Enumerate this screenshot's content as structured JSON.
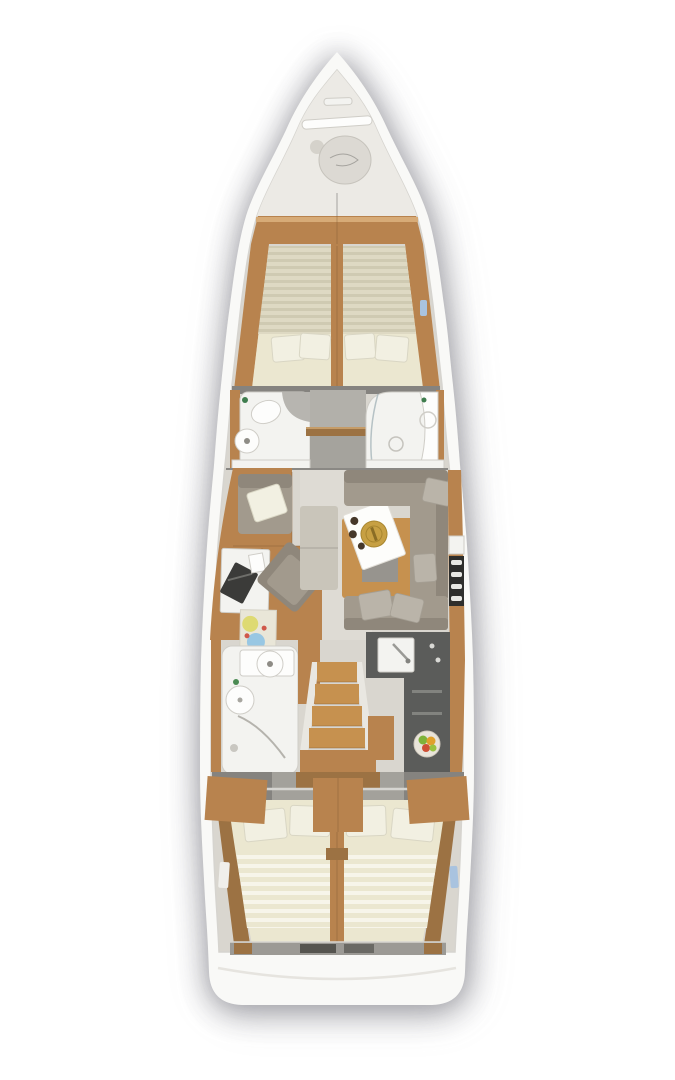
{
  "colors": {
    "page_bg": "#ffffff",
    "hull": "#f9f9f7",
    "hull_edge": "#d6d4cf",
    "deck_bow": "#eceae5",
    "floor": "#d9d6cf",
    "floor_light": "#e0ddd6",
    "wall_dark": "#85837f",
    "wall_gray": "#b2b0aa",
    "corridor_lower": "#a5a39d",
    "wood": "#b8834e",
    "wood_light": "#c6914f",
    "wood_dark": "#9c7243",
    "wood_line": "#7c5730",
    "counter_dark": "#5b5c5a",
    "fixture": "#f3f3f0",
    "fixture_line": "#cfcdc7",
    "sofa": "#a29a8d",
    "sofa_dark": "#8f877b",
    "sofa_pillow": "#bab4a9",
    "mattress_fwd": "#ded9c3",
    "mattress_fwd_stripe": "#cfcab2",
    "mattress_aft": "#ebe7d0",
    "mattress_aft_stripe": "#f7f5ea",
    "pillow": "#f2f0e2",
    "pillow_edge": "#d9d6c4",
    "hatch_blue": "#a9c3df",
    "brass": "#c7a043",
    "steel": "#9a9a96",
    "chart_yellow": "#ddd867",
    "chart_blue": "#8fc3e4",
    "chart_red": "#d0584a",
    "fruit_green": "#7fb33a",
    "fruit_orange": "#e0a12c",
    "fruit_red": "#cf4f35"
  },
  "floor_plan": {
    "vessel": "sailing-yacht interior floor plan, top view, bow up",
    "sections_bow_to_stern": [
      "anchor-locker",
      "forward-cabin-v-berth",
      "port-forward-head",
      "starboard-forward-shower",
      "salon",
      "port-aft-head",
      "companionway-stairs",
      "starboard-galley",
      "port-aft-cabin",
      "starboard-aft-cabin",
      "transom"
    ],
    "features": [
      {
        "area": "anchor-locker",
        "items": [
          "windlass-bar",
          "anchor-rope-coil"
        ]
      },
      {
        "area": "forward-cabin",
        "items": [
          "split-v-berth",
          "four-pillows",
          "wood-side-shelves",
          "blue-deck-hatch"
        ]
      },
      {
        "area": "port-forward-head",
        "items": [
          "toilet",
          "round-washbasin"
        ]
      },
      {
        "area": "starboard-forward-shower",
        "items": [
          "shower-pan-with-drain",
          "washbasin"
        ]
      },
      {
        "area": "salon",
        "items": [
          "armchair-with-pillow",
          "nav-desk-with-laptop",
          "swivel-chair",
          "chart-rug",
          "dining-table",
          "serving-tray-with-brass-plate",
          "bench",
          "l-shaped-sofa-with-pillows",
          "sideboard-bottle-rack"
        ]
      },
      {
        "area": "galley",
        "items": [
          "l-shaped-dark-counter",
          "square-sink-with-faucet",
          "fruit-bowl"
        ]
      },
      {
        "area": "companionway",
        "items": [
          "four-wood-steps",
          "landing-platform"
        ]
      },
      {
        "area": "port-aft-head",
        "items": [
          "washbasin-counter",
          "toilet",
          "shower-with-curved-screen"
        ]
      },
      {
        "area": "port-aft-cabin",
        "items": [
          "double-berth",
          "two-pillows",
          "wardrobe"
        ]
      },
      {
        "area": "starboard-aft-cabin",
        "items": [
          "double-berth",
          "two-pillows",
          "wardrobe"
        ]
      },
      {
        "area": "transom",
        "items": [
          "stern-step-strip",
          "white-transom-platform"
        ]
      }
    ]
  }
}
